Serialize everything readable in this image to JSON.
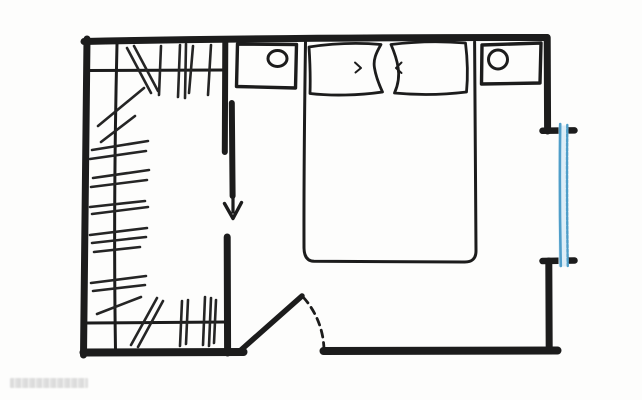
{
  "document": {
    "kind": "hand-drawn floor plan sketch",
    "scene": "bedroom with walk-in closet, double bed, two nightstands with lamps, entry door and window"
  },
  "palette": {
    "ink": "#1c1c1c",
    "paper": "#fdfdfc",
    "window_blue": "#4f9ec9",
    "window_glass": "#dcedf7",
    "watermark_gray": "#c3c3c3"
  },
  "labels": {
    "plan": "Bedroom floor plan sketch",
    "walls": "Room walls",
    "closet": "Walk-in closet with hanging rods and clothes strokes",
    "rod_top": "Closet hanging rod (top)",
    "rod_left": "Closet hanging rod (left)",
    "rod_bottom": "Closet hanging rod (bottom)",
    "partition": "Partition wall between closet and bedroom",
    "sliding_door": "Sliding closet door leaf",
    "arrow": "Sliding direction arrow (down)",
    "bed": "Double bed",
    "pillow_left": "Pillow (left)",
    "pillow_right": "Pillow (right)",
    "nightstand_left": "Nightstand with round lamp (left)",
    "nightstand_right": "Nightstand with round lamp (right)",
    "entry_door": "Entry door leaf with dashed swing arc",
    "window": "Window on right wall (blue)"
  },
  "hatches": {
    "top": [
      [
        127,
        48,
        151,
        93
      ],
      [
        134,
        46,
        158,
        91
      ],
      [
        161,
        46,
        159,
        95
      ],
      [
        180,
        45,
        178,
        97
      ],
      [
        186,
        44,
        185,
        98
      ],
      [
        193,
        46,
        189,
        93
      ],
      [
        211,
        45,
        208,
        95
      ]
    ],
    "left": [
      [
        98,
        126,
        144,
        88
      ],
      [
        101,
        142,
        135,
        116
      ],
      [
        92,
        150,
        148,
        141
      ],
      [
        90,
        159,
        146,
        151
      ],
      [
        93,
        178,
        149,
        170
      ],
      [
        91,
        187,
        147,
        180
      ],
      [
        90,
        207,
        145,
        201
      ],
      [
        92,
        214,
        148,
        207
      ],
      [
        90,
        235,
        147,
        228
      ],
      [
        92,
        243,
        146,
        237
      ],
      [
        94,
        252,
        140,
        247
      ],
      [
        91,
        283,
        146,
        276
      ],
      [
        93,
        291,
        145,
        285
      ],
      [
        97,
        314,
        141,
        297
      ]
    ],
    "bottom": [
      [
        131,
        345,
        157,
        298
      ],
      [
        138,
        347,
        163,
        301
      ],
      [
        182,
        301,
        180,
        346
      ],
      [
        188,
        300,
        186,
        344
      ],
      [
        205,
        297,
        203,
        345
      ],
      [
        211,
        298,
        209,
        346
      ],
      [
        216,
        300,
        214,
        343
      ]
    ]
  },
  "watermark": {
    "present": true,
    "legible": false
  }
}
